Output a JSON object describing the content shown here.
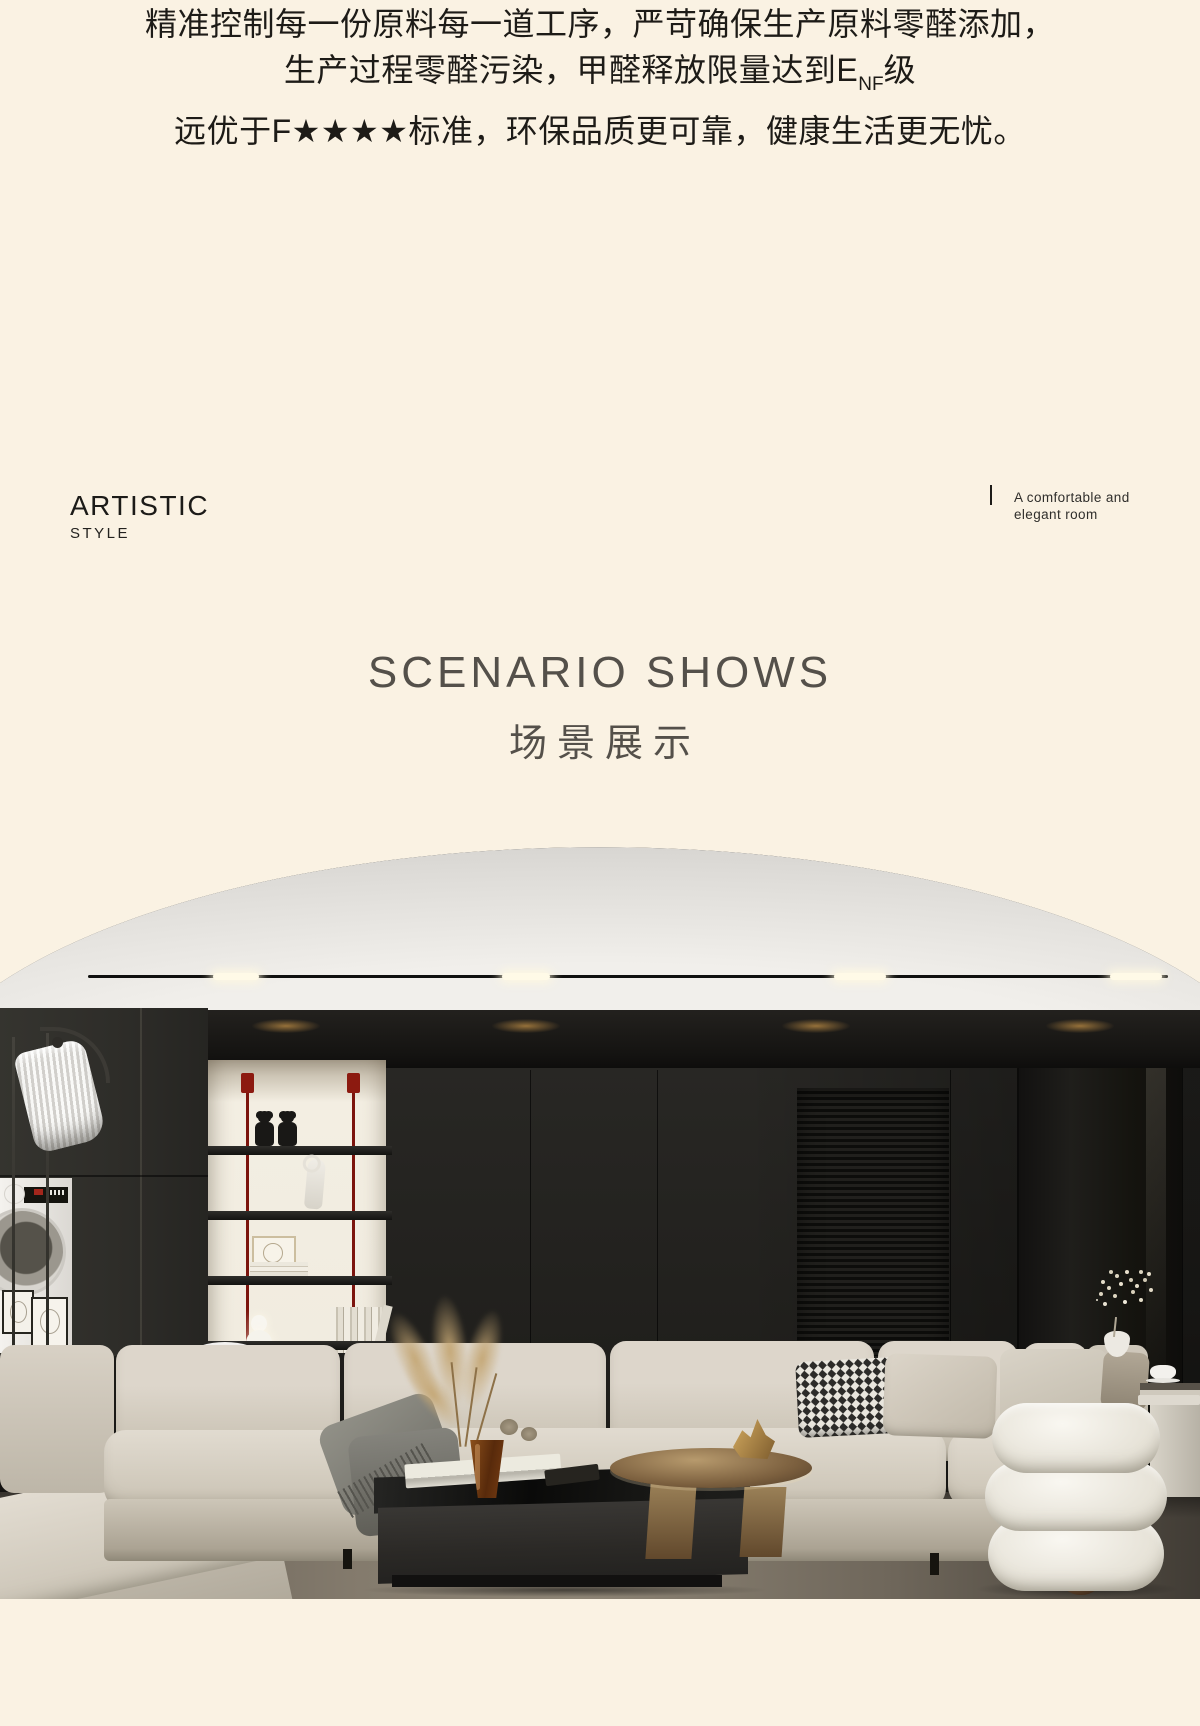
{
  "colors": {
    "page_background": "#faf2e3",
    "intro_text": "#1d1b17",
    "section_heading": "#54504a",
    "niche_backlight": "#f3eee2",
    "shelf_rod_red": "#7c140d",
    "sofa_beige": "#d6cfc3",
    "wall_black": "#21201d",
    "floor_brown": "#7d7466"
  },
  "intro": {
    "line1": "精准控制每一份原料每一道工序，严苛确保生产原料零醛添加，",
    "line2_prefix": "生产过程零醛污染，甲醛释放限量达到E",
    "line2_sub": "NF",
    "line2_suffix": "级",
    "line3": "远优于F★★★★标准，环保品质更可靠，健康生活更无忧。"
  },
  "artistic": {
    "title": "ARTISTIC",
    "subtitle": "STYLE"
  },
  "side_note": {
    "line1": "A comfortable and",
    "line2": "elegant room"
  },
  "section": {
    "en": "SCENARIO SHOWS",
    "zh": "场景展示"
  }
}
